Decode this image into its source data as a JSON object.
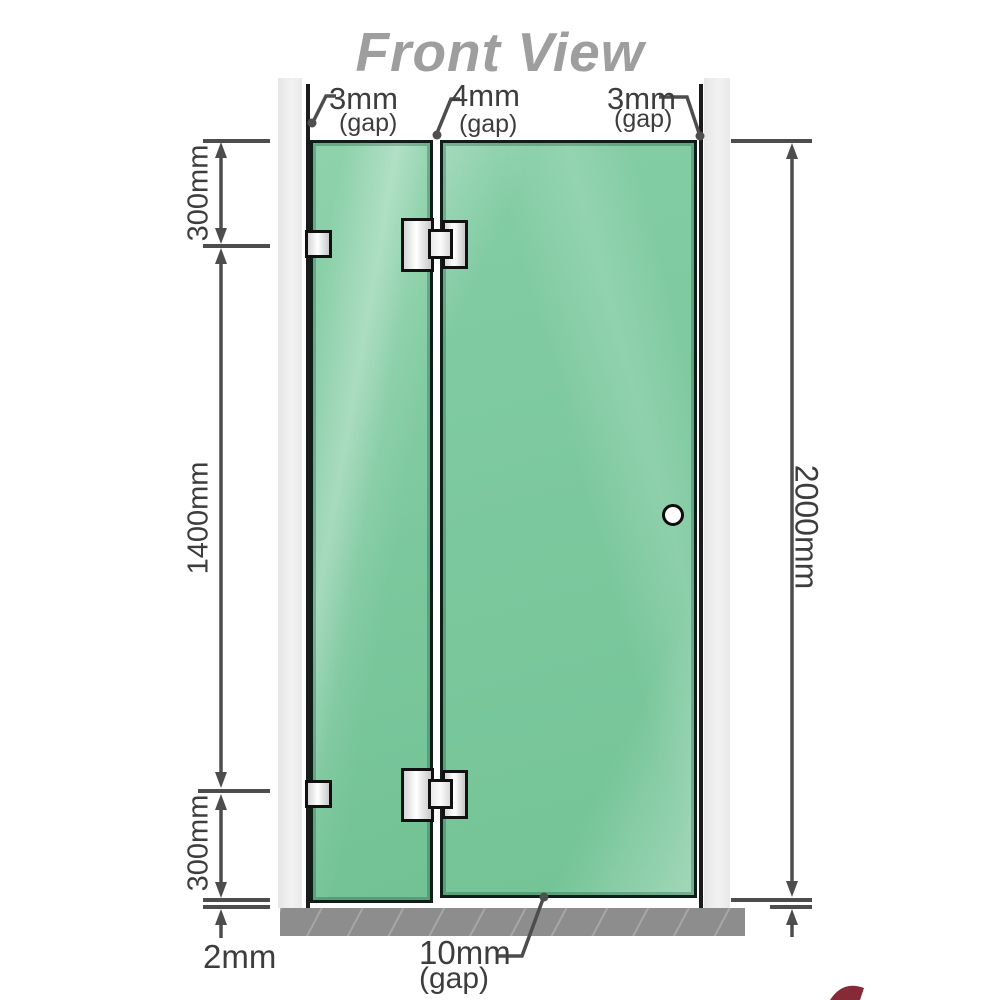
{
  "title": "Front View",
  "annotations": {
    "top_left_gap": {
      "value": "3mm",
      "suffix": "(gap)"
    },
    "top_middle_gap": {
      "value": "4mm",
      "suffix": "(gap)"
    },
    "top_right_gap": {
      "value": "3mm",
      "suffix": "(gap)"
    },
    "bottom_door_gap": {
      "value": "10mm",
      "suffix": "(gap)"
    },
    "bottom_floor_gap": {
      "value": "2mm"
    }
  },
  "dimensions": {
    "left_top": "300mm",
    "left_middle": "1400mm",
    "left_bottom": "300mm",
    "right_full": "2000mm"
  },
  "colors": {
    "glass": "#7cc89e",
    "glass_border": "#0d1f16",
    "wall_channel": "#ebebeb",
    "floor_base": "#8d8d8d",
    "dimension_lines": "#4d4d4d",
    "title_text": "#9e9e9e",
    "hardware_fill": "#f2f2f2",
    "logo_accent": "#7a1322"
  }
}
